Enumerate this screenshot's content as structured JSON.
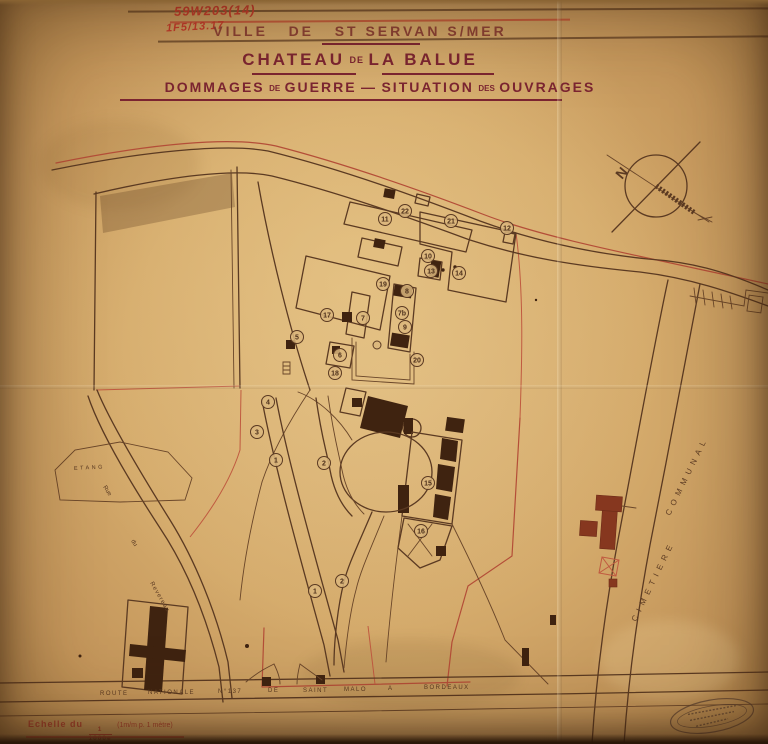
{
  "document": {
    "archive_ref": "59W203(14)",
    "secondary_ref": "1F5/13.17",
    "title_city": "VILLE   DE   ST SERVAN S/MER",
    "title_chateau": {
      "word1": "CHATEAU",
      "word2": "DE",
      "word3": "LA BALUE"
    },
    "subtitle": {
      "part1": "DOMMAGES",
      "part2": "DE",
      "part3": "GUERRE",
      "dash": "—",
      "part4": "SITUATION",
      "part5": "DES",
      "part6": "OUVRAGES"
    },
    "scale_label": "Echelle du",
    "scale_fraction_num": "1",
    "scale_fraction_den": "1000e",
    "scale_note": "(1m/m p. 1 mètre)"
  },
  "map": {
    "north_label": "N",
    "labels": {
      "etang": "ETANG",
      "rue_word1": "Rue",
      "rue_word2": "du",
      "rue_word3": "Revereau",
      "cimetiere": "CIMETIERE",
      "communal": "COMMUNAL"
    },
    "route_words": [
      "ROUTE",
      "NATIONALE",
      "N°137",
      "DE",
      "SAINT",
      "MALO",
      "A",
      "BORDEAUX"
    ],
    "markers": [
      {
        "n": "1",
        "x": 276,
        "y": 460
      },
      {
        "n": "2",
        "x": 324,
        "y": 463
      },
      {
        "n": "1",
        "x": 315,
        "y": 591
      },
      {
        "n": "2",
        "x": 342,
        "y": 581
      },
      {
        "n": "3",
        "x": 257,
        "y": 432
      },
      {
        "n": "4",
        "x": 268,
        "y": 402
      },
      {
        "n": "5",
        "x": 297,
        "y": 337
      },
      {
        "n": "6",
        "x": 340,
        "y": 355
      },
      {
        "n": "7",
        "x": 363,
        "y": 318
      },
      {
        "n": "7b",
        "x": 402,
        "y": 313
      },
      {
        "n": "8",
        "x": 407,
        "y": 291
      },
      {
        "n": "9",
        "x": 405,
        "y": 327
      },
      {
        "n": "10",
        "x": 428,
        "y": 256
      },
      {
        "n": "11",
        "x": 385,
        "y": 219
      },
      {
        "n": "12",
        "x": 507,
        "y": 228
      },
      {
        "n": "13",
        "x": 431,
        "y": 271
      },
      {
        "n": "14",
        "x": 459,
        "y": 273
      },
      {
        "n": "15",
        "x": 428,
        "y": 483
      },
      {
        "n": "16",
        "x": 421,
        "y": 531
      },
      {
        "n": "17",
        "x": 327,
        "y": 315
      },
      {
        "n": "18",
        "x": 335,
        "y": 373
      },
      {
        "n": "19",
        "x": 383,
        "y": 284
      },
      {
        "n": "20",
        "x": 417,
        "y": 360
      },
      {
        "n": "21",
        "x": 451,
        "y": 221
      },
      {
        "n": "22",
        "x": 405,
        "y": 211
      }
    ]
  },
  "colors": {
    "paper": "#d6ac6e",
    "ink_sepia": "#5b3a22",
    "ink_red": "#b44e38",
    "title_maroon": "#7c2531",
    "handwriting_red": "#c23a2a",
    "building_dark": "#3f2310"
  }
}
